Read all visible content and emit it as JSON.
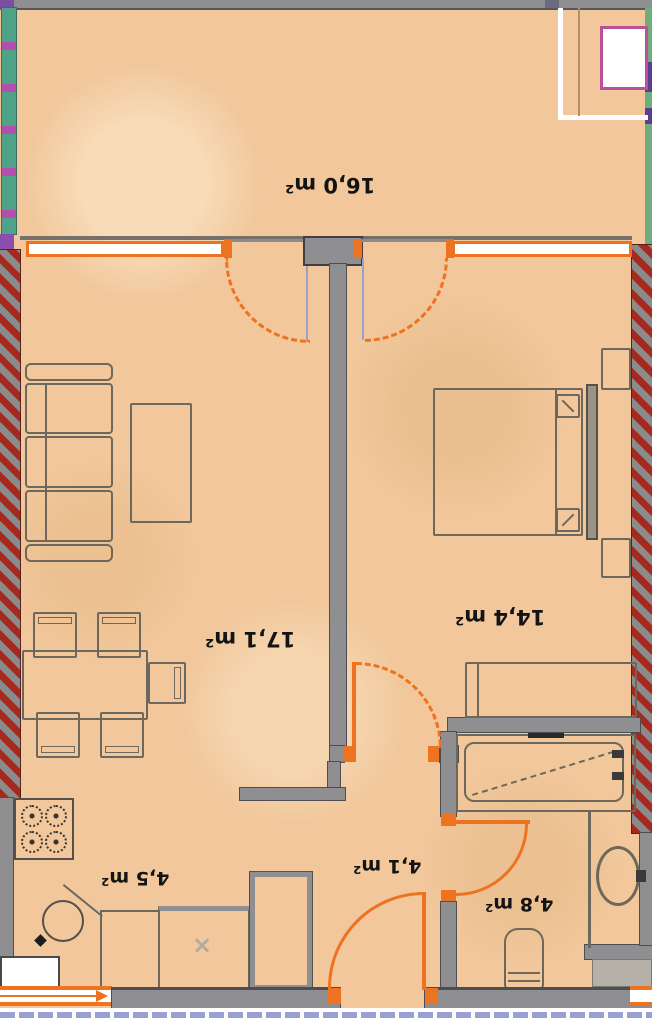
{
  "document": {
    "type": "apartment-floor-plan",
    "orientation": "labels rotated 180 degrees"
  },
  "rooms": {
    "balcony": {
      "label": "16,0 m²"
    },
    "living_room": {
      "label": "17,1 m²"
    },
    "bedroom": {
      "label": "14,4 m²"
    },
    "kitchen": {
      "label": "4,5 m²"
    },
    "hallway": {
      "label": "4,1 m²"
    },
    "bathroom": {
      "label": "4,8 m²"
    }
  },
  "markers": {
    "kitchen_cross": "×"
  },
  "colors": {
    "floor": "#f1c79b",
    "wall_gray": "#8f8f92",
    "load_bearing_hatch_red": "#a5291f",
    "accent_orange": "#ee7320",
    "magenta_border": "#b8509a",
    "teal_strip": "#4ea287",
    "green_strip": "#6fae7c",
    "checker_blue": "#98a0d4",
    "furniture_line": "#6e685c"
  }
}
